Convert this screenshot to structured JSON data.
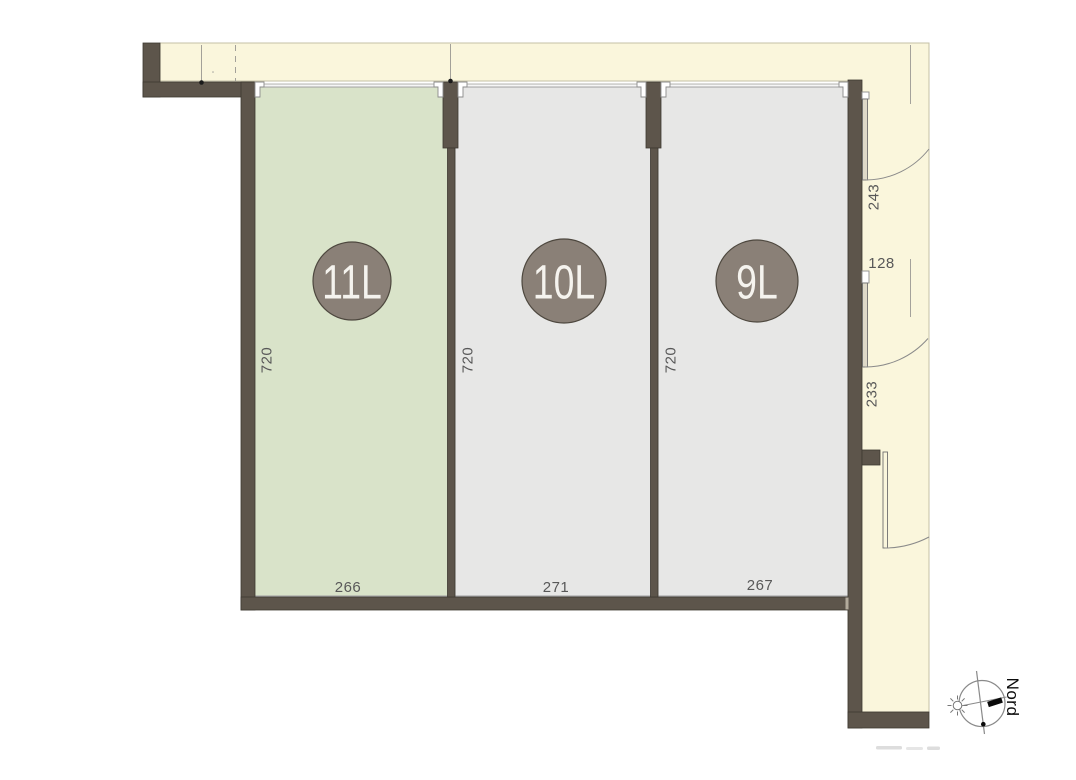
{
  "units": [
    {
      "badge": "11L",
      "depth": "720",
      "width": "266",
      "selected": true
    },
    {
      "badge": "10L",
      "depth": "720",
      "width": "271",
      "selected": false
    },
    {
      "badge": "9L",
      "depth": "720",
      "width": "267",
      "selected": false
    }
  ],
  "side_dimensions": [
    {
      "label": "243"
    },
    {
      "label": "128"
    },
    {
      "label": "233"
    }
  ],
  "compass": {
    "north_label": "Nord"
  },
  "colors": {
    "selected_unit_green": "#D9E3C9",
    "unit_gray": "#E7E7E6",
    "wall_brown": "#5D554B",
    "exterior_cream": "#FAF6DC",
    "badge_brown": "#8A8077"
  }
}
